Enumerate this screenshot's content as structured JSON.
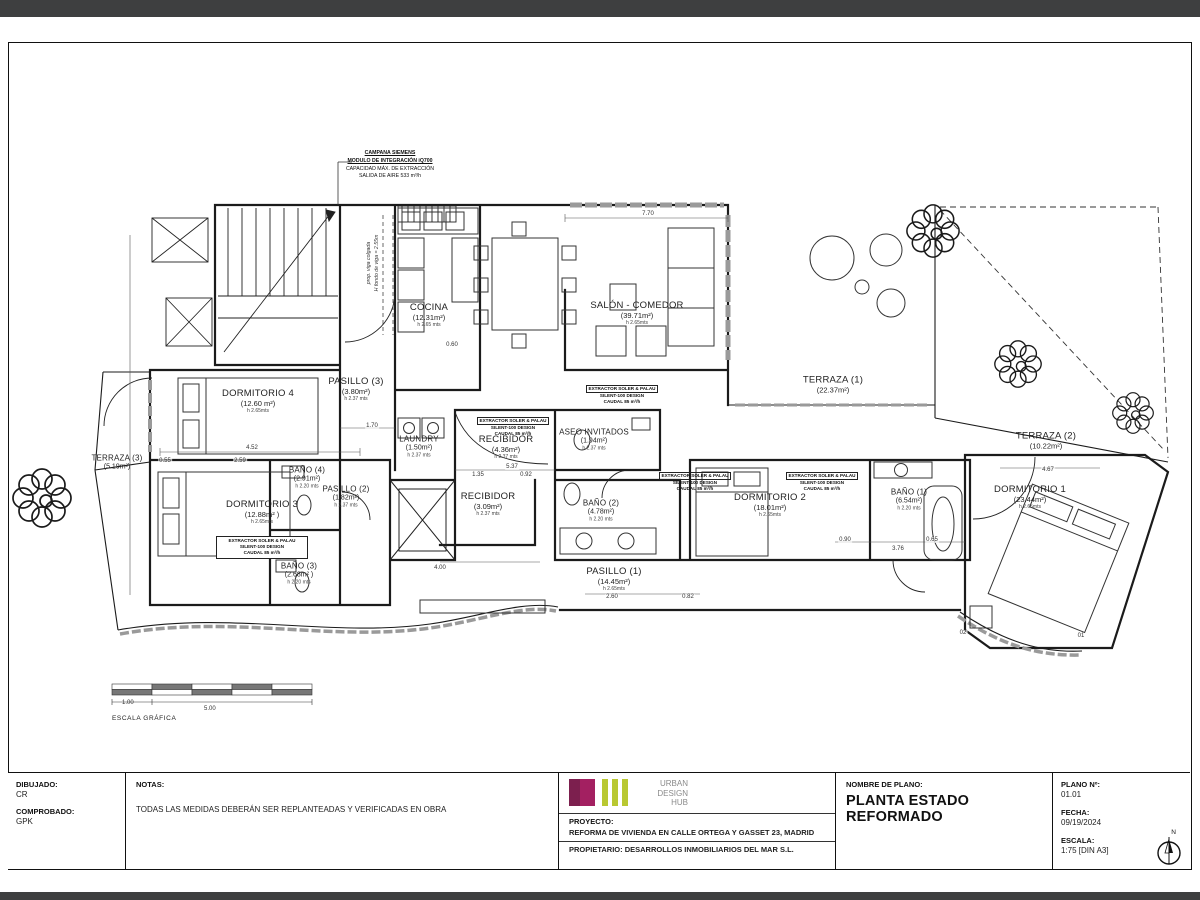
{
  "plan": {
    "rooms": [
      {
        "name": "TERRAZA (3)",
        "area": "(5.19m²)"
      },
      {
        "name": "DORMITORIO 4",
        "area": "(12.60 m²)",
        "h": "h 2.65mts"
      },
      {
        "name": "DORMITORIO 3",
        "area": "(12.88m² )",
        "h": "h 2.65mts"
      },
      {
        "name": "BAÑO (4)",
        "area": "(2.91m²)",
        "h": "h 2.20 mts"
      },
      {
        "name": "PASILLO (2)",
        "area": "(1.82m²)",
        "h": "h 2.37 mts"
      },
      {
        "name": "BAÑO (3)",
        "area": "(2.68m² )",
        "h": "h 2.20 mts"
      },
      {
        "name": "COCINA",
        "area": "(12.31m²)",
        "h": "h 2.65 mts"
      },
      {
        "name": "PASILLO (3)",
        "area": "(3.80m²)",
        "h": "h 2.37 mts"
      },
      {
        "name": "LAUNDRY",
        "area": "(1.50m²)",
        "h": "h 2.37 mts"
      },
      {
        "name": "RECIBIDOR",
        "area": "(4.36m²)",
        "h": "h 2.37 mts"
      },
      {
        "name": "ASEO INVITADOS",
        "area": "(1.94m²)",
        "h": "h 2.37 mts"
      },
      {
        "name": "RECIBIDOR",
        "area": "(3.09m²)",
        "h": "h 2.37 mts"
      },
      {
        "name": "SALÓN - COMEDOR",
        "area": "(39.71m²)",
        "h": "h 2.65mts"
      },
      {
        "name": "TERRAZA (1)",
        "area": "(22.37m²)"
      },
      {
        "name": "TERRAZA (2)",
        "area": "(10.22m²)"
      },
      {
        "name": "DORMITORIO 1",
        "area": "(23.44m²)",
        "h": "h 2.65mts"
      },
      {
        "name": "BAÑO (1)",
        "area": "(6.54m²)",
        "h": "h 2.20 mts"
      },
      {
        "name": "DORMITORIO 2",
        "area": "(18.01m²)",
        "h": "h 2.65mts"
      },
      {
        "name": "BAÑO (2)",
        "area": "(4.78m²)",
        "h": "h 2.20 mts"
      },
      {
        "name": "PASILLO (1)",
        "area": "(14.45m²)",
        "h": "h 2.65mts"
      }
    ],
    "extractor": {
      "l1": "EXTRACTOR SOLER & PALAU",
      "l2": "SILENT-100 DESIGN",
      "l3": "CAUDAL 85 m³/h"
    },
    "campana": {
      "l1": "CAMPANA SIEMENS",
      "l2": "MODULO DE INTEGRACIÓN iQ700",
      "l3": "CAPACIDAD MÁX. DE EXTRACCIÓN",
      "l4": "SALIDA DE AIRE 533 m³/h"
    },
    "beam": {
      "l1": "prop. viga colgada",
      "l2": "H fondo de viga = 2.55m"
    },
    "dims": [
      "7.70",
      "4.52",
      "2.59",
      "0.55",
      "0.60",
      "1.70",
      "5.37",
      "1.35",
      "0.92",
      "4.67",
      "3.76",
      "0.90",
      "0.65",
      "2.60",
      "0.82",
      "4.00",
      "02",
      "01"
    ],
    "scalebar": {
      "caption": "ESCALA GRÁFICA",
      "minor": "1.00",
      "major": "5.00"
    }
  },
  "titleblock": {
    "dibujado_label": "DIBUJADO:",
    "dibujado": "CR",
    "comprobado_label": "COMPROBADO:",
    "comprobado": "GPK",
    "notas_label": "NOTAS:",
    "notas": "TODAS LAS MEDIDAS DEBERÁN SER REPLANTEADAS Y VERIFICADAS EN OBRA",
    "logo": {
      "l1": "URBAN",
      "l2": "DESIGN",
      "l3": "HUB"
    },
    "proyecto_label": "PROYECTO:",
    "proyecto": "REFORMA DE VIVIENDA EN CALLE ORTEGA Y GASSET 23, MADRID",
    "propietario": "PROPIETARIO: DESARROLLOS INMOBILIARIOS DEL MAR S.L.",
    "nombre_label": "NOMBRE DE PLANO:",
    "nombre": "PLANTA ESTADO REFORMADO",
    "plano_label": "PLANO Nº:",
    "plano": "01.01",
    "fecha_label": "FECHA:",
    "fecha": "09/19/2024",
    "escala_label": "ESCALA:",
    "escala": "1:75 [DIN A3]",
    "north": "N"
  },
  "colors": {
    "accent_magenta_dark": "#7c1f4e",
    "accent_magenta": "#a32061",
    "accent_lime": "#b9c832",
    "page_bar": "#3e3f40"
  }
}
